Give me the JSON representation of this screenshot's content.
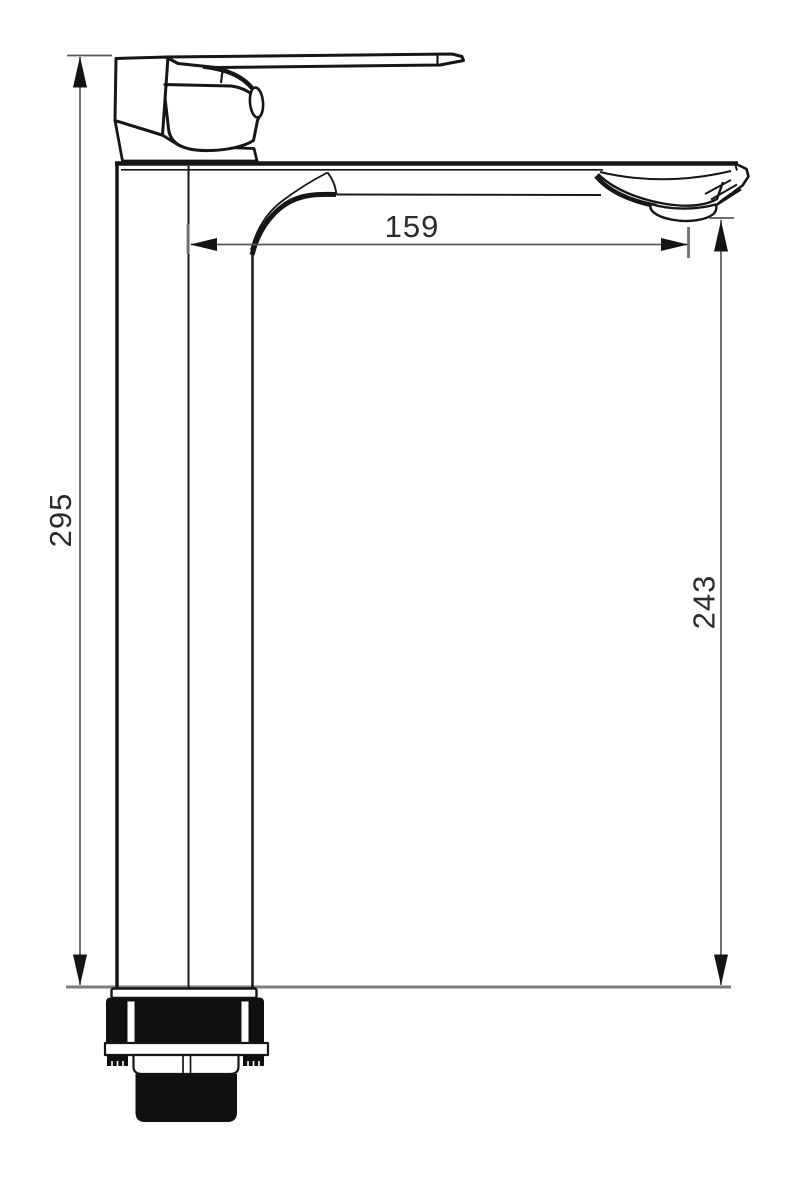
{
  "drawing": {
    "type": "technical-dimension-drawing",
    "subject": "Tall single-lever basin mixer tap, side elevation",
    "background": "#ffffff",
    "colors": {
      "outline": "#161616",
      "solid_fill": "#101010",
      "deck_line": "#7c7c7c",
      "dimension_line": "#5a5a5a",
      "dimension_text": "#2a2a31"
    },
    "dimensions": {
      "overall_height": {
        "value": "295",
        "orientation": "vertical",
        "location": "left"
      },
      "spout_reach": {
        "value": "159",
        "orientation": "horizontal",
        "location": "top-center"
      },
      "outlet_height": {
        "value": "243",
        "orientation": "vertical",
        "location": "right"
      }
    }
  }
}
